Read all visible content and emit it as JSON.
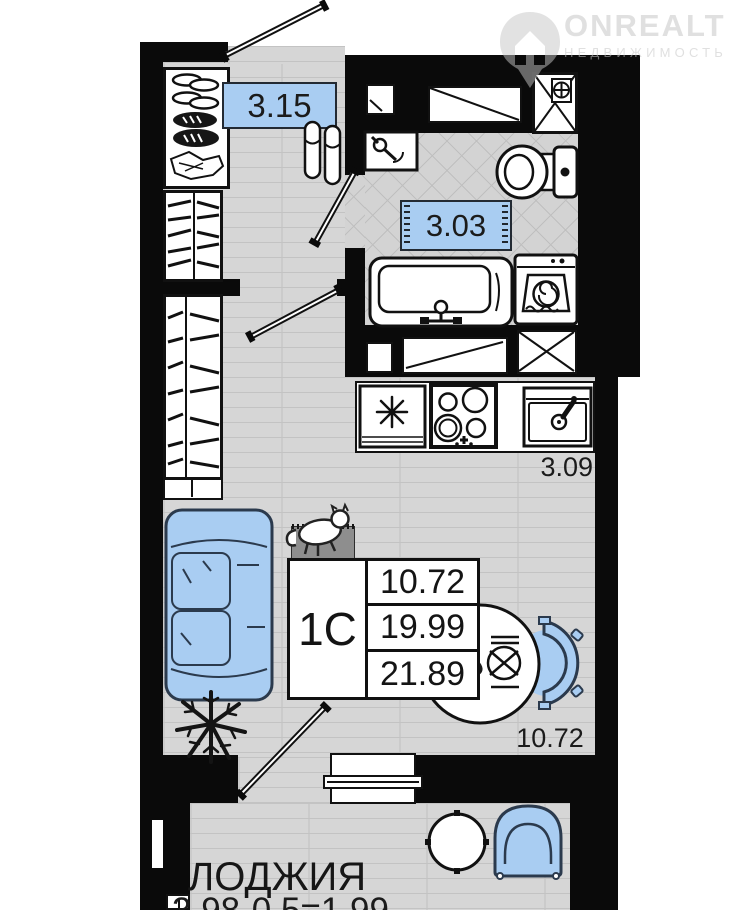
{
  "watermark": {
    "brand": "ONREALT",
    "subtitle": "НЕДВИЖИМОСТЬ"
  },
  "plan_labels": {
    "hallway_area": "3.15",
    "bathroom_area": "3.03",
    "kitchen_area": "3.09",
    "living_area": "10.72",
    "loggia_title": "ЛОДЖИЯ",
    "loggia_formula": "3.98·0.5=1.99"
  },
  "unit_card": {
    "unit_type": "1C",
    "area_rows": [
      "10.72",
      "19.99",
      "21.89"
    ]
  },
  "colors": {
    "accent_blue": "#a9cdf2",
    "wall_black": "#0a0a0a",
    "floor_gray": "#d6d6d6"
  }
}
